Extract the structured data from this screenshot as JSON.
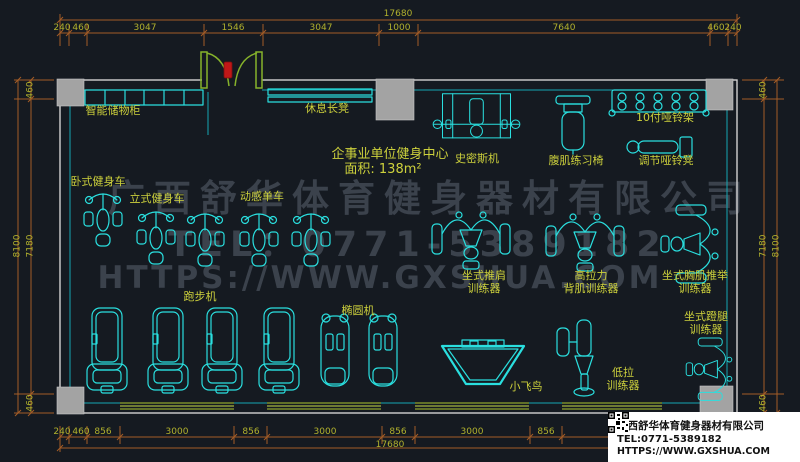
{
  "dims": {
    "top_total": "17680",
    "top": [
      "240",
      "460",
      "3047",
      "1546",
      "3047",
      "1000",
      "7640",
      "460",
      "240"
    ],
    "bottom": [
      "240",
      "460",
      "856",
      "3000",
      "856",
      "3000",
      "856",
      "3000",
      "856"
    ],
    "bottom_total": "17680",
    "left_outer": "8100",
    "left": [
      "460",
      "7180",
      "460"
    ],
    "right": [
      "460",
      "7180",
      "460"
    ],
    "right_outer": "8100"
  },
  "room": {
    "title": "企事业单位健身中心",
    "area": "面积: 138m²"
  },
  "labels": {
    "locker": "智能储物柜",
    "rest_bench": "休息长凳",
    "smith": "史密斯机",
    "ab_chair": "腹肌练习椅",
    "dumbbell_rack": "10付哑铃架",
    "dumbbell_bench": "调节哑铃凳",
    "recumbent_bike": "卧式健身车",
    "upright_bike": "立式健身车",
    "spin_bike": "动感单车",
    "shoulder_press_1": "坐式推肩",
    "shoulder_press_2": "训练器",
    "lat_pull_1": "高拉力",
    "lat_pull_2": "背肌训练器",
    "chest_press_1": "坐式胸肌推举",
    "chest_press_2": "训练器",
    "treadmill": "跑步机",
    "elliptical": "椭圆机",
    "cable_fly": "小飞鸟",
    "low_row_1": "低拉",
    "low_row_2": "训练器",
    "leg_press_1": "坐式蹬腿",
    "leg_press_2": "训练器"
  },
  "watermark": {
    "line1": "广西舒华体育健身器材有限公司",
    "line2": "TEL：0771-5389182",
    "line3": "HTTPS://WWW.GXSHUA.COM"
  },
  "info_box": {
    "company": "广西舒华体育健身器材有限公司",
    "tel": "TEL:0771-5389182",
    "url": "HTTPS://WWW.GXSHUA.COM"
  },
  "colors": {
    "background": "#151a21",
    "equipment_cyan": "#2adfdf",
    "label_yellow": "#cdd13c",
    "dimension_line": "#a35c26",
    "dimension_text": "#b1b12d",
    "wall_gray": "#d2d2d2",
    "door_green": "#86b32b",
    "window_green": "#8fa32c",
    "watermark_gray": "#3b424c",
    "door_handle_red": "#c01818"
  }
}
